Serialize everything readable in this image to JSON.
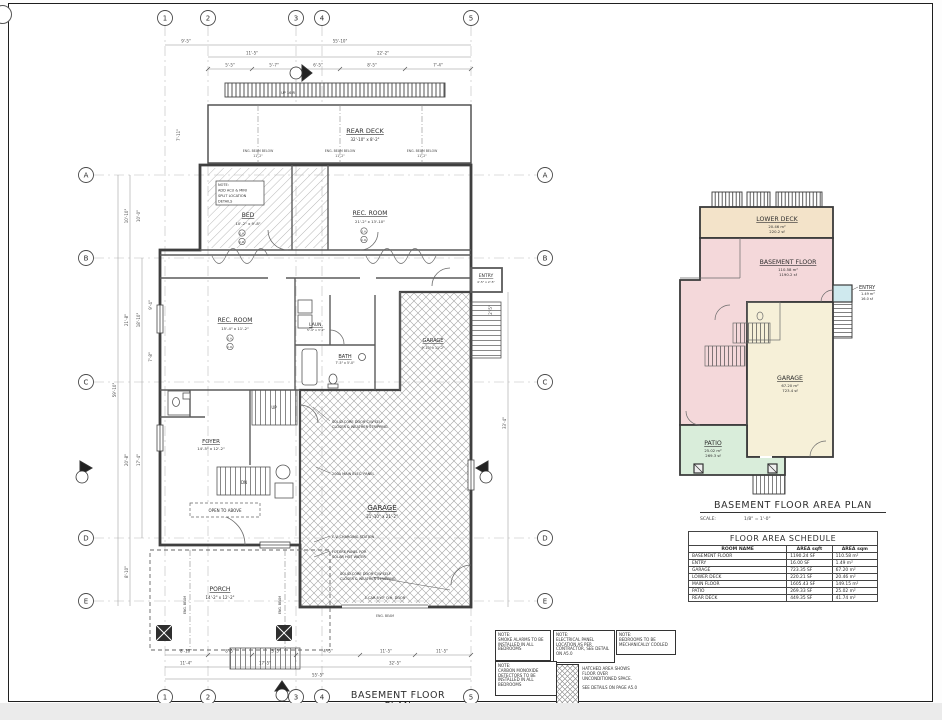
{
  "sheet": {
    "plan_title": "BASEMENT FLOOR PLAN",
    "area_plan_title": "BASEMENT FLOOR AREA PLAN",
    "scale_label": "SCALE:",
    "scale_value": "1/8\" = 1'-0\""
  },
  "grid": {
    "cols": [
      "1",
      "2",
      "3",
      "4",
      "5"
    ],
    "rows": [
      "A",
      "B",
      "C",
      "D",
      "E"
    ]
  },
  "plan": {
    "rooms": {
      "rear_deck": {
        "label": "REAR DECK",
        "dims": "32'-10\" x 8'-2\""
      },
      "bed": {
        "label": "BED",
        "dims": "10'-2\" x 9'-8\""
      },
      "rec_upper": {
        "label": "REC. ROOM",
        "dims": "21'-2\" x 13'-10\""
      },
      "rec_lower": {
        "label": "REC. ROOM",
        "dims": "15'-4\" x 11'-2\""
      },
      "laundry": {
        "label": "LAUN.",
        "dims": "5'-4\" x 3'-2\""
      },
      "bath": {
        "label": "BATH",
        "dims": "7'-5\" x 5'-0\""
      },
      "entry": {
        "label": "ENTRY",
        "dims": "4'-5\" x 2'-5\""
      },
      "garage_upper": {
        "label": "GARAGE",
        "dims": "9'-10\" x 11'-2\""
      },
      "garage": {
        "label": "GARAGE",
        "dims": "21'-10\" x 21'-2\""
      },
      "foyer": {
        "label": "FOYER",
        "dims": "14'-5\" x 12'-2\""
      },
      "porch": {
        "label": "PORCH",
        "dims": "14'-2\" x 12'-2\""
      },
      "open_above": "OPEN TO ABOVE"
    },
    "stair_labels": {
      "up": "UP",
      "dn": "DN",
      "up16": "UP 16 R"
    },
    "alarm": {
      "sa": "S.A.",
      "co": "C.O."
    },
    "bed_note": [
      "NOTE:",
      "ADD ACU & MINI",
      "SPLIT LOCATION",
      "DETAILS"
    ],
    "beam_note": "ENG. BEAM BELOW",
    "beam_note2": "ENG. BEAM",
    "deck_dim": "11'-2\"",
    "leaders": [
      [
        "SOLID CORE DOOR C/W SELF",
        "CLOSER & WEATHER STRIPPING"
      ],
      [
        "200A MAIN ELEC. PANEL"
      ],
      [
        "E.V. CHARGING STATION"
      ],
      [
        "FUTURE PANEL FOR",
        "SOLAR HOT WATER"
      ],
      [
        "SOLID CORE DOOR C/W SELF",
        "CLOSER & WEATHER STRIPPING"
      ],
      [
        "1 CAR 8'x7' O.H. DOOR"
      ]
    ],
    "dims_top": [
      "9'-5\"",
      "55'-10\"",
      "11'-5\"",
      "22'-2\"",
      "5'-5\"",
      "5'-7\"",
      "6'-5\"",
      "8'-5\"",
      "7'-4\""
    ],
    "dims_left": [
      "10'-10\"",
      "10'-0\"",
      "21'-8\"",
      "18'-10\"",
      "9'-4\"",
      "7'-8\"",
      "20'-8\"",
      "17'-4\"",
      "8'-10\"",
      "59'-10\"",
      "7'-11\""
    ],
    "dims_right": [
      "2'-5\"",
      "33'-4\""
    ],
    "dims_bottom": [
      "8'-10\"",
      "8'-5\"",
      "3'-5\"",
      "4'-5\"",
      "11'-5\"",
      "11'-5\"",
      "11'-4\"",
      "17'-5\"",
      "32'-5\"",
      "55'-5\""
    ]
  },
  "area_plan": {
    "rooms": [
      {
        "name": "LOWER DECK",
        "metric": "20.46 m²",
        "imperial": "220.2 sf"
      },
      {
        "name": "BASEMENT FLOOR",
        "metric": "110.58 m²",
        "imperial": "1190.2 sf"
      },
      {
        "name": "ENTRY",
        "metric": "1.49 m²",
        "imperial": "16.0 sf"
      },
      {
        "name": "GARAGE",
        "metric": "67.20 m²",
        "imperial": "723.4 sf"
      },
      {
        "name": "PATIO",
        "metric": "25.02 m²",
        "imperial": "269.3 sf"
      }
    ],
    "colors": {
      "deck": "#f3e3c9",
      "basement": "#f4d8da",
      "entry": "#cfe9ee",
      "garage": "#f6f0d8",
      "patio": "#d9edda"
    }
  },
  "schedule": {
    "title": "FLOOR AREA SCHEDULE",
    "headers": [
      "ROOM NAME",
      "AREA sqft",
      "AREA sqm"
    ],
    "rows": [
      {
        "name": "BASEMENT FLOOR",
        "sqft": "1190.24 SF",
        "sqm": "110.58 m²"
      },
      {
        "name": "ENTRY",
        "sqft": "16.00 SF",
        "sqm": "1.49 m²"
      },
      {
        "name": "GARAGE",
        "sqft": "723.35 SF",
        "sqm": "67.20 m²"
      },
      {
        "name": "LOWER DECK",
        "sqft": "220.21 SF",
        "sqm": "20.46 m²"
      },
      {
        "name": "MAIN FLOOR",
        "sqft": "1605.43 SF",
        "sqm": "149.15 m²"
      },
      {
        "name": "PATIO",
        "sqft": "269.33 SF",
        "sqm": "25.02 m²"
      },
      {
        "name": "REAR DECK",
        "sqft": "449.35 SF",
        "sqm": "41.74 m²"
      }
    ]
  },
  "notes": [
    {
      "title": "NOTE:",
      "body": "SMOKE ALARMS TO BE INSTALLED IN ALL BEDROOMS"
    },
    {
      "title": "NOTE:",
      "body": "ELECTRICAL PANEL LOCATION AS PER CONTRACTOR, SEE DETAIL ON A5.0"
    },
    {
      "title": "NOTE:",
      "body": "BEDROOMS TO BE MECHANICALLY COOLED"
    },
    {
      "title": "NOTE:",
      "body": "CARBON MONOXIDE DETECTORS TO BE INSTALLED IN ALL BEDROOMS"
    }
  ],
  "legend": {
    "line1": "HATCHED AREA SHOWS FLOOR OVER UNCONDITIONED SPACE.",
    "line2": "SEE DETAILS ON PAGE A5.0"
  }
}
